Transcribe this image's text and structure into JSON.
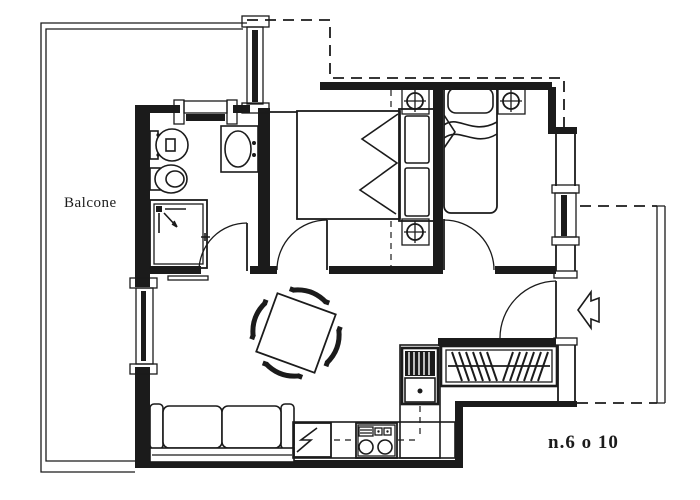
{
  "page": {
    "background": "#ffffff",
    "line_color": "#1b1b1b"
  },
  "labels": {
    "balcony": "Balcone",
    "unit_number": "n.6 o 10"
  },
  "fixtures": [
    "balcony-railing",
    "toilet",
    "bidet",
    "washbasin",
    "shower",
    "double-bed",
    "pillow-panel",
    "column-marker",
    "single-bed",
    "dining-table",
    "chair",
    "sofa",
    "fridge",
    "cooktop",
    "kitchen-sink",
    "radiator",
    "entrance-door",
    "entrance-arrow",
    "terrace-railing",
    "window",
    "door-swing"
  ]
}
